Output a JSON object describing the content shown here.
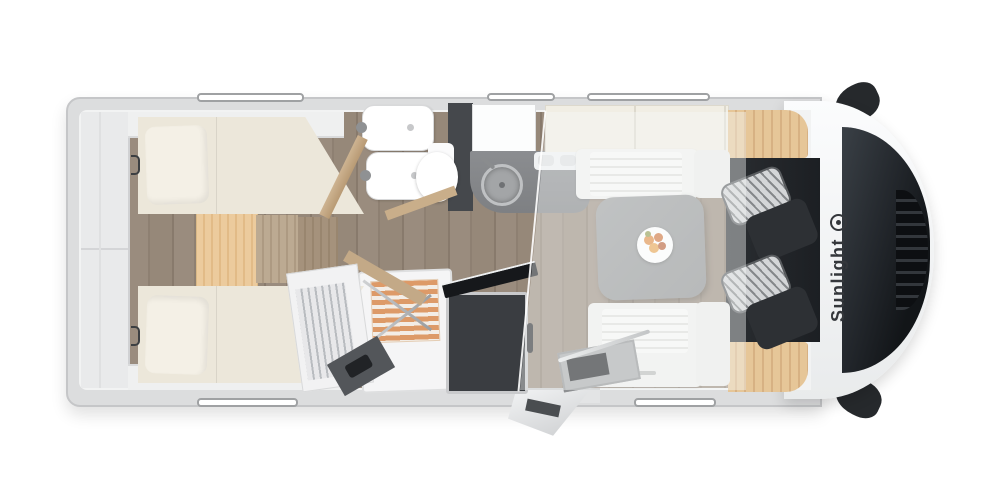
{
  "brand": {
    "name": "Sunlight",
    "logo_icon": "sun-icon"
  },
  "colors": {
    "body_shell": "#e9ebec",
    "wall_gray": "#dcddde",
    "interior_white": "#f2f3f3",
    "floor_wood": "#94867a",
    "mattress_cream": "#ece7da",
    "oak_accent": "#e3c295",
    "dark_cabinet": "#3a3d41",
    "kitchen_counter": "#85878a",
    "table_gray": "#949697",
    "cab_dark": "#1d2125",
    "seat_stripe_light": "#d4d6d8",
    "seat_stripe_dark": "#85888b",
    "shower_slats": "#dd9a68",
    "brand_text": "#34373b"
  }
}
